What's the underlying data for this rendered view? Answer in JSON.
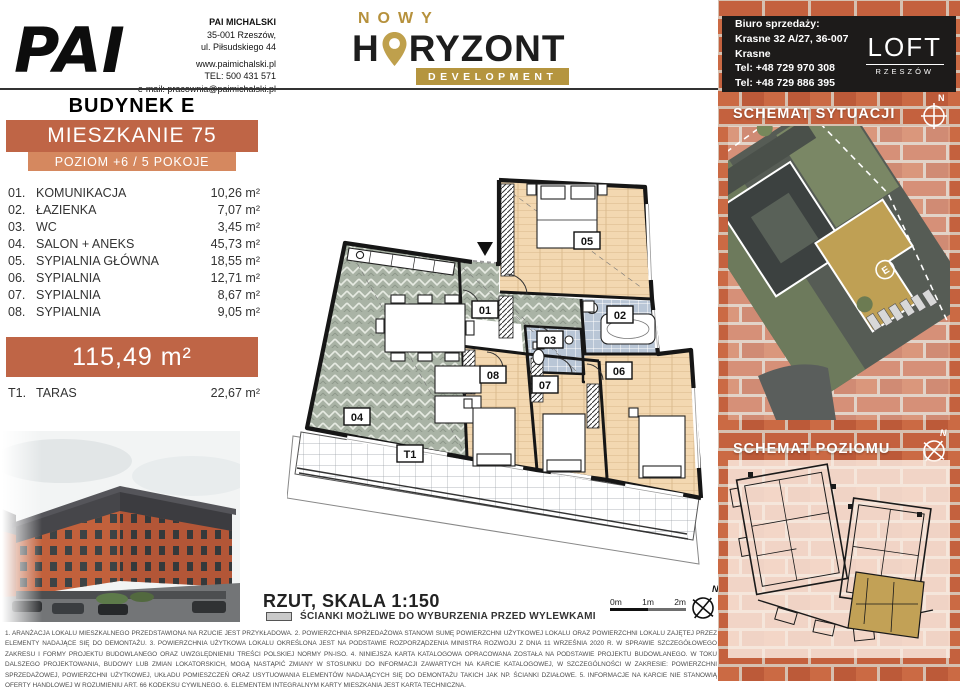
{
  "header": {
    "architect": {
      "logo": "PAI",
      "name": "PAI MICHALSKI",
      "line1": "35-001 Rzeszów,",
      "line2": "ul. Piłsudskiego 44",
      "line3": "www.paimichalski.pl",
      "line4": "TEL: 500 431 571",
      "line5": "e-mail: pracownia@paimichalski.pl"
    },
    "brand": {
      "top": "NOWY",
      "main_left": "H",
      "main_right": "RYZONT",
      "banner": "DEVELOPMENT"
    },
    "sales": {
      "title": "Biuro sprzedaży:",
      "address": "Krasne 32 A/27, 36-007 Krasne",
      "phone1": "Tel: +48 729 970 308",
      "phone2": "Tel: +48 729 886 395"
    },
    "loft": {
      "name": "LOFT",
      "city": "RZESZÓW"
    }
  },
  "unit": {
    "building": "BUDYNEK E",
    "apartment": "MIESZKANIE 75",
    "level": "POZIOM +6 / 5 POKOJE",
    "rooms": [
      {
        "no": "01.",
        "name": "KOMUNIKACJA",
        "area": "10,26 m²"
      },
      {
        "no": "02.",
        "name": "ŁAZIENKA",
        "area": "7,07 m²"
      },
      {
        "no": "03.",
        "name": "WC",
        "area": "3,45 m²"
      },
      {
        "no": "04.",
        "name": "SALON + ANEKS",
        "area": "45,73 m²"
      },
      {
        "no": "05.",
        "name": "SYPIALNIA GŁÓWNA",
        "area": "18,55 m²"
      },
      {
        "no": "06.",
        "name": "SYPIALNIA",
        "area": "12,71 m²"
      },
      {
        "no": "07.",
        "name": "SYPIALNIA",
        "area": "8,67 m²"
      },
      {
        "no": "08.",
        "name": "SYPIALNIA",
        "area": "9,05 m²"
      }
    ],
    "total_area": "115,49 m²",
    "terrace": {
      "no": "T1.",
      "name": "TARAS",
      "area": "22,67 m²"
    }
  },
  "plan": {
    "title": "RZUT, SKALA 1:150",
    "legend": "ŚCIANKI MOŻLIWE DO WYBURZENIA PRZED WYLEWKAMI",
    "scale": [
      "0m",
      "1m",
      "2m"
    ],
    "north": "N",
    "labels": {
      "r01": "01",
      "r02": "02",
      "r03": "03",
      "r04": "04",
      "r05": "05",
      "r06": "06",
      "r07": "07",
      "r08": "08",
      "t1": "T1"
    }
  },
  "sidebar": {
    "section_situation": "SCHEMAT SYTUACJI",
    "section_level": "SCHEMAT POZIOMU",
    "building_marker": "E",
    "north": "N"
  },
  "footnotes": "1. ARANŻACJA LOKALU MIESZKALNEGO PRZEDSTAWIONA NA RZUCIE JEST PRZYKŁADOWA.  2. POWIERZCHNIA SPRZEDAŻOWA STANOWI SUMĘ POWIERZCHNI UŻYTKOWEJ LOKALU ORAZ POWIERZCHNI LOKALU ZAJĘTEJ PRZEZ ELEMENTY NADAJĄCE SIĘ DO DEMONTAŻU.  3. POWIERZCHNIA UŻYTKOWA LOKALU OKREŚLONA JEST NA PODSTAWIE ROZPORZĄDZENIA MINISTRA ROZWOJU Z DNIA 11 WRZEŚNIA 2020 R. W SPRAWIE SZCZEGÓŁOWEGO ZAKRESU I FORMY PROJEKTU BUDOWLANEGO ORAZ UWZGLĘDNIENIU TREŚCI POLSKIEJ NORMY PN-ISO.  4. NINIEJSZA KARTA KATALOGOWA OPRACOWANA ZOSTAŁA NA PODSTAWIE PROJEKTU BUDOWLANEGO. W TOKU DALSZEGO PROJEKTOWANIA, BUDOWY LUB ZMIAN LOKATORSKICH, MOGĄ NASTĄPIĆ ZMIANY W STOSUNKU DO INFORMACJI ZAWARTYCH NA KARCIE KATALOGOWEJ, W SZCZEGÓLNOŚCI W ZAKRESIE: POWIERZCHNI SPRZEDAŻOWEJ, POWIERZCHNI UŻYTKOWEJ, UKŁADU POMIESZCZEŃ ORAZ USYTUOWANIA ELEMENTÓW NADAJĄCYCH SIĘ DO DEMONTAŻU TAKICH JAK NP. ŚCIANKI DZIAŁOWE.  5. INFORMACJE NA KARCIE NIE STANOWIĄ OFERTY HANDLOWEJ W ROZUMIENIU ART. 66 KODEKSU CYWILNEGO.  6. ELEMENTEM INTEGRALNYM KARTY MIESZKANIA JEST KARTA TECHNICZNA.",
  "colors": {
    "accent_dark": "#bf6546",
    "accent_light": "#d5885f",
    "gold": "#b5953f",
    "brick": "#c2603d"
  }
}
